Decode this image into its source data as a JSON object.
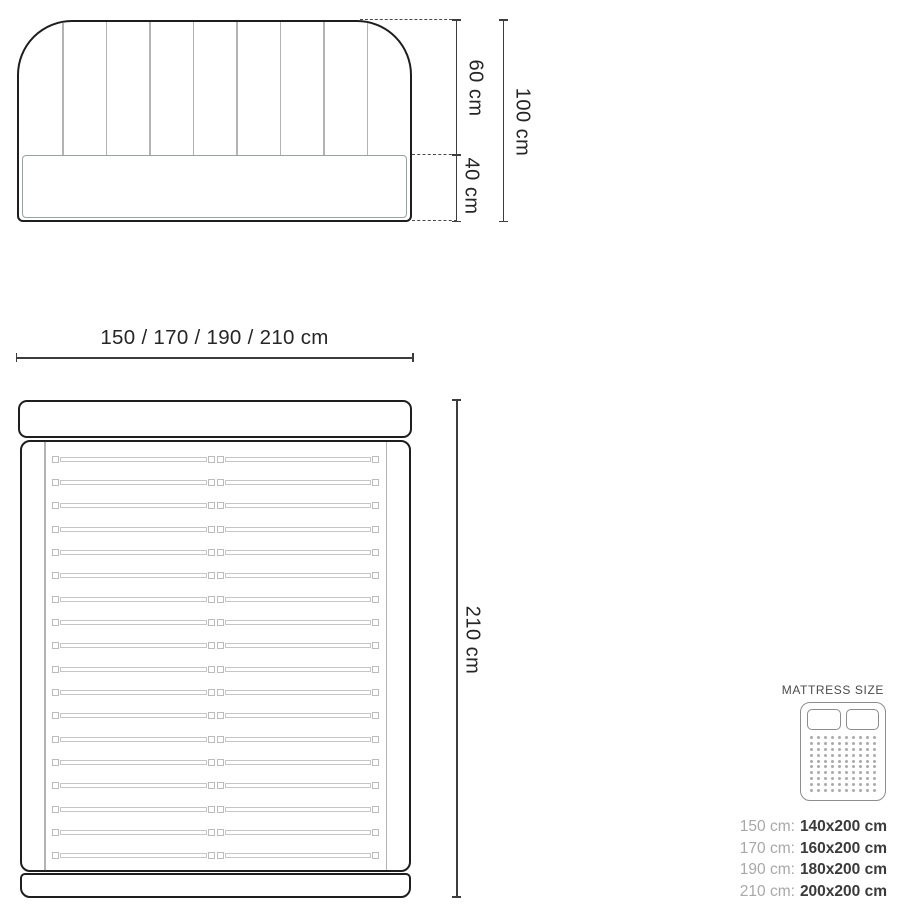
{
  "front_view": {
    "channel_line_count": 8,
    "dim_upper": "60 cm",
    "dim_lower": "40 cm",
    "dim_total": "100 cm"
  },
  "width_dim": {
    "label": "150 / 170 / 190 / 210 cm"
  },
  "plan_view": {
    "slat_count": 18,
    "dim_length": "210 cm"
  },
  "legend": {
    "title": "MATTRESS SIZE",
    "icon": {
      "name": "double-mattress-icon",
      "dot_rows": 10,
      "dot_cols": 10
    },
    "rows": [
      {
        "size": "150 cm:",
        "mattress": "140x200 cm"
      },
      {
        "size": "170 cm:",
        "mattress": "160x200 cm"
      },
      {
        "size": "190 cm:",
        "mattress": "180x200 cm"
      },
      {
        "size": "210 cm:",
        "mattress": "200x200 cm"
      }
    ]
  },
  "colors": {
    "outline": "#1e1e1e",
    "detail": "#b3b3b3",
    "dim": "#3d3d3d",
    "text": "#262626",
    "legend-label": "#a8a8a8",
    "legend-value": "#3a3a3a",
    "legend-icon": "#8d8d8d"
  }
}
